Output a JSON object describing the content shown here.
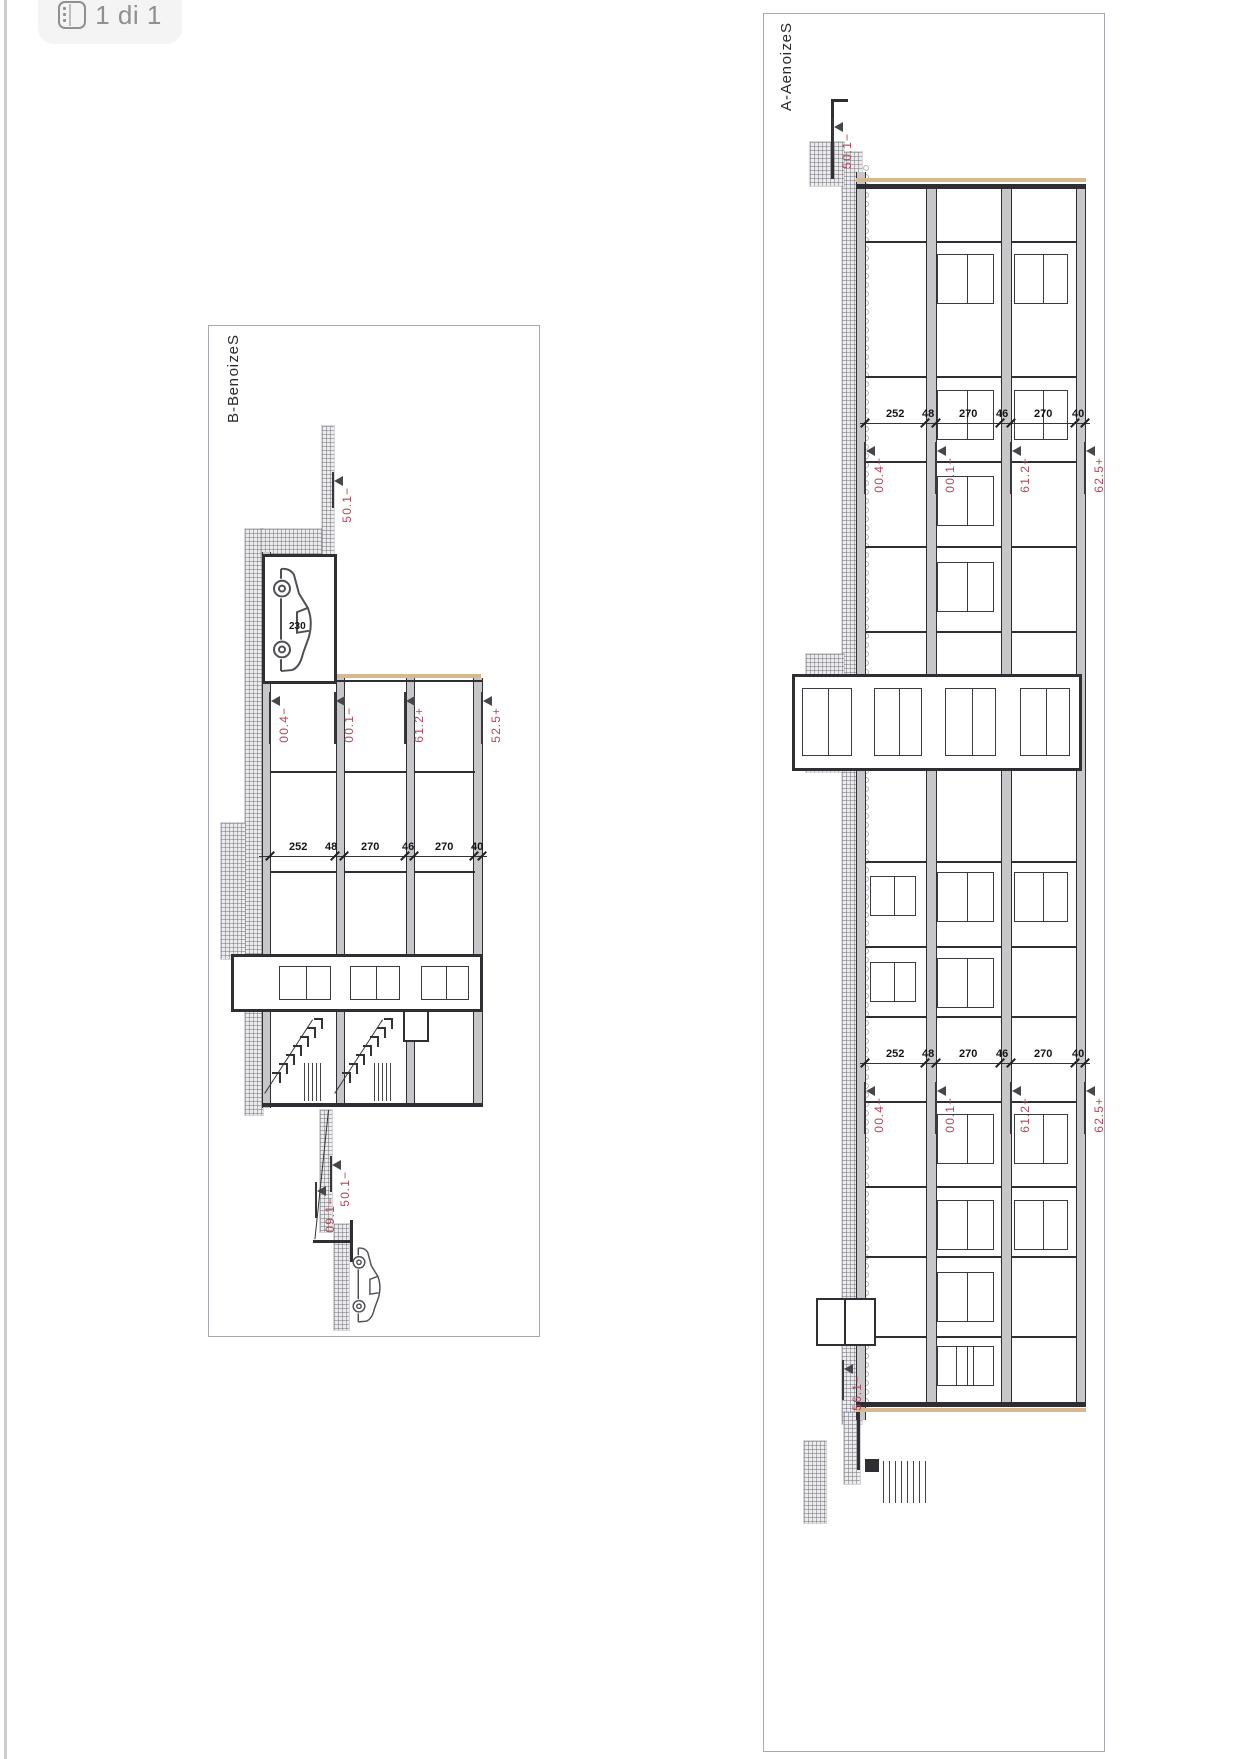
{
  "toolbar": {
    "page_indicator": "1 di 1",
    "icon": "pages-icon"
  },
  "colors": {
    "red": "#bd4258",
    "line": "#2e2e33",
    "slab_fill": "#c7c7ca",
    "tan": "#d8b88e",
    "panel_border": "#a8a8b0"
  },
  "panels": [
    {
      "id": "bb",
      "title": "Sezione B-B",
      "frame": {
        "left": 208,
        "top": 325,
        "width": 332,
        "height": 1012
      },
      "natural": {
        "w": 1012,
        "h": 332
      },
      "prims": [
        {
          "t": "title",
          "x": 8,
          "y": 300,
          "text": "Sezione B-B",
          "size": 15
        },
        {
          "t": "hatch",
          "x": 203,
          "y": 278,
          "w": 586,
          "h": 18
        },
        {
          "t": "hatch",
          "x": 203,
          "y": 214,
          "w": 32,
          "h": 66
        },
        {
          "t": "hatch",
          "x": 100,
          "y": 207,
          "w": 136,
          "h": 12
        },
        {
          "t": "hatch",
          "x": 497,
          "y": 296,
          "w": 136,
          "h": 24
        },
        {
          "t": "hatch",
          "x": 784,
          "y": 209,
          "w": 122,
          "h": 12
        },
        {
          "t": "hatch",
          "x": 898,
          "y": 192,
          "w": 106,
          "h": 15
        },
        {
          "t": "slab",
          "x": 352,
          "y": 58,
          "w": 428,
          "h": 10
        },
        {
          "t": "slab",
          "x": 352,
          "y": 126,
          "w": 428,
          "h": 9
        },
        {
          "t": "slab",
          "x": 352,
          "y": 196,
          "w": 428,
          "h": 9
        },
        {
          "t": "slab",
          "x": 228,
          "y": 204,
          "w": 130,
          "h": 8
        },
        {
          "t": "slab",
          "x": 226,
          "y": 270,
          "w": 556,
          "h": 9
        },
        {
          "t": "vline",
          "x": 777,
          "y": 58,
          "len": 221,
          "w": 4
        },
        {
          "t": "tan",
          "x": 348,
          "y": 60,
          "len": 144,
          "w": 4
        },
        {
          "t": "vline",
          "x": 354,
          "y": 58,
          "len": 146,
          "w": 2
        },
        {
          "t": "rect",
          "x": 228,
          "y": 204,
          "w": 130,
          "h": 75,
          "bw": 3
        },
        {
          "t": "vline",
          "x": 445,
          "y": 66,
          "len": 60,
          "w": 2
        },
        {
          "t": "vline",
          "x": 445,
          "y": 135,
          "len": 61,
          "w": 2
        },
        {
          "t": "vline",
          "x": 445,
          "y": 205,
          "len": 65,
          "w": 2
        },
        {
          "t": "vline",
          "x": 545,
          "y": 66,
          "len": 60,
          "w": 2
        },
        {
          "t": "vline",
          "x": 545,
          "y": 135,
          "len": 61,
          "w": 2
        },
        {
          "t": "vline",
          "x": 545,
          "y": 205,
          "len": 65,
          "w": 2
        },
        {
          "t": "rect",
          "x": 628,
          "y": 58,
          "w": 58,
          "h": 252,
          "bw": 3
        },
        {
          "t": "door",
          "x": 640,
          "y": 72,
          "w": 34,
          "h": 48
        },
        {
          "t": "door",
          "x": 640,
          "y": 141,
          "w": 34,
          "h": 50
        },
        {
          "t": "door",
          "x": 640,
          "y": 210,
          "w": 34,
          "h": 52
        },
        {
          "t": "rect",
          "x": 684,
          "y": 112,
          "w": 32,
          "h": 26,
          "bw": 2
        },
        {
          "t": "steps",
          "x": 692,
          "y": 148,
          "n": 7,
          "dx": 9,
          "dy": 7
        },
        {
          "t": "diag",
          "x": 694,
          "y": 158,
          "len": 88,
          "a": 33
        },
        {
          "t": "steps",
          "x": 692,
          "y": 218,
          "n": 7,
          "dx": 9,
          "dy": 7
        },
        {
          "t": "diag",
          "x": 694,
          "y": 228,
          "len": 88,
          "a": 33
        },
        {
          "t": "pack",
          "x": 737,
          "y": 150,
          "n": 5,
          "gap": 4,
          "len": 38
        },
        {
          "t": "pack",
          "x": 737,
          "y": 220,
          "n": 5,
          "gap": 4,
          "len": 38
        },
        {
          "t": "car",
          "x": 240,
          "y": 226,
          "w": 108,
          "h": 44
        },
        {
          "t": "num",
          "x": 296,
          "y": 252,
          "text": "230",
          "size": 10
        },
        {
          "t": "chain",
          "x": 530,
          "y": 54,
          "len": 228
        },
        {
          "t": "ticks",
          "x": 530,
          "ys": [
            58,
            66,
            126,
            135,
            196,
            205,
            270
          ]
        },
        {
          "t": "num",
          "x": 516,
          "y": 252,
          "text": "252",
          "size": 11
        },
        {
          "t": "num",
          "x": 516,
          "y": 216,
          "text": "48",
          "size": 11
        },
        {
          "t": "num",
          "x": 516,
          "y": 180,
          "text": "270",
          "size": 11
        },
        {
          "t": "num",
          "x": 516,
          "y": 139,
          "text": "46",
          "size": 11
        },
        {
          "t": "num",
          "x": 516,
          "y": 106,
          "text": "270",
          "size": 11
        },
        {
          "t": "num",
          "x": 516,
          "y": 70,
          "text": "40",
          "size": 11
        },
        {
          "t": "marker",
          "x": 366,
          "y": 270,
          "text": "−4.00"
        },
        {
          "t": "marker",
          "x": 366,
          "y": 205,
          "text": "−1.00"
        },
        {
          "t": "marker",
          "x": 366,
          "y": 135,
          "text": "+2.16"
        },
        {
          "t": "marker",
          "x": 366,
          "y": 58,
          "text": "+5.25"
        },
        {
          "t": "marker",
          "x": 146,
          "y": 207,
          "text": "−1.05",
          "len": 36
        },
        {
          "t": "marker",
          "x": 830,
          "y": 209,
          "text": "−1.05",
          "len": 36
        },
        {
          "t": "marker",
          "x": 856,
          "y": 224,
          "text": "−1.90",
          "len": 36
        },
        {
          "t": "diag",
          "x": 784,
          "y": 212,
          "len": 130,
          "a": 6
        },
        {
          "t": "vline",
          "x": 914,
          "y": 190,
          "len": 38,
          "w": 3
        },
        {
          "t": "hline",
          "x": 894,
          "y": 188,
          "len": 42,
          "w": 3
        },
        {
          "t": "car",
          "x": 920,
          "y": 158,
          "w": 78,
          "h": 32
        }
      ]
    },
    {
      "id": "aa",
      "title": "Sezione A-A",
      "frame": {
        "left": 763,
        "top": 13,
        "width": 342,
        "height": 1739
      },
      "natural": {
        "w": 1739,
        "h": 342
      },
      "prims": [
        {
          "t": "title",
          "x": 8,
          "y": 312,
          "text": "Sezione A-A",
          "size": 15
        },
        {
          "t": "hatch",
          "x": 138,
          "y": 244,
          "w": 1272,
          "h": 20
        },
        {
          "t": "pebbles",
          "x": 150,
          "y": 236,
          "w": 1240,
          "h": 8
        },
        {
          "t": "hatch",
          "x": 640,
          "y": 262,
          "w": 118,
          "h": 38
        },
        {
          "t": "hatch",
          "x": 128,
          "y": 262,
          "w": 44,
          "h": 34
        },
        {
          "t": "hatch",
          "x": 1398,
          "y": 246,
          "w": 72,
          "h": 16
        },
        {
          "t": "hatch",
          "x": 1427,
          "y": 280,
          "w": 82,
          "h": 22
        },
        {
          "t": "slab",
          "x": 170,
          "y": 20,
          "w": 1222,
          "h": 10
        },
        {
          "t": "slab",
          "x": 170,
          "y": 94,
          "w": 1222,
          "h": 11
        },
        {
          "t": "slab",
          "x": 170,
          "y": 169,
          "w": 1222,
          "h": 11
        },
        {
          "t": "slab",
          "x": 158,
          "y": 240,
          "w": 1248,
          "h": 10
        },
        {
          "t": "vline",
          "x": 170,
          "y": 20,
          "len": 230,
          "w": 5
        },
        {
          "t": "vline",
          "x": 1388,
          "y": 20,
          "len": 230,
          "w": 5
        },
        {
          "t": "tan",
          "x": 164,
          "y": 20,
          "len": 230,
          "w": 4
        },
        {
          "t": "tan",
          "x": 1394,
          "y": 20,
          "len": 230,
          "w": 4
        },
        {
          "t": "wallset",
          "xs": [
            227,
            362,
            447,
            532,
            617,
            847,
            932,
            1002,
            1087,
            1172,
            1242,
            1322
          ],
          "w": 2
        },
        {
          "t": "rect",
          "x": 660,
          "y": 24,
          "w": 97,
          "h": 290,
          "bw": 3
        },
        {
          "t": "door",
          "x": 674,
          "y": 36,
          "w": 68,
          "h": 50
        },
        {
          "t": "door",
          "x": 674,
          "y": 110,
          "w": 68,
          "h": 51
        },
        {
          "t": "door",
          "x": 674,
          "y": 184,
          "w": 68,
          "h": 48
        },
        {
          "t": "door",
          "x": 674,
          "y": 254,
          "w": 68,
          "h": 50
        },
        {
          "t": "door",
          "x": 240,
          "y": 112,
          "w": 50,
          "h": 57
        },
        {
          "t": "door",
          "x": 376,
          "y": 112,
          "w": 50,
          "h": 57
        },
        {
          "t": "door",
          "x": 462,
          "y": 112,
          "w": 50,
          "h": 57
        },
        {
          "t": "door",
          "x": 548,
          "y": 112,
          "w": 50,
          "h": 57
        },
        {
          "t": "door",
          "x": 858,
          "y": 112,
          "w": 50,
          "h": 57
        },
        {
          "t": "door",
          "x": 944,
          "y": 112,
          "w": 50,
          "h": 57
        },
        {
          "t": "door",
          "x": 1100,
          "y": 112,
          "w": 50,
          "h": 57
        },
        {
          "t": "door",
          "x": 1186,
          "y": 112,
          "w": 50,
          "h": 57
        },
        {
          "t": "door",
          "x": 1258,
          "y": 112,
          "w": 50,
          "h": 57
        },
        {
          "t": "door",
          "x": 1332,
          "y": 112,
          "w": 40,
          "h": 57
        },
        {
          "t": "door",
          "x": 240,
          "y": 38,
          "w": 50,
          "h": 54
        },
        {
          "t": "door",
          "x": 376,
          "y": 38,
          "w": 50,
          "h": 54
        },
        {
          "t": "door",
          "x": 858,
          "y": 38,
          "w": 50,
          "h": 54
        },
        {
          "t": "door",
          "x": 1100,
          "y": 38,
          "w": 50,
          "h": 54
        },
        {
          "t": "door",
          "x": 1186,
          "y": 38,
          "w": 50,
          "h": 54
        },
        {
          "t": "door",
          "x": 862,
          "y": 190,
          "w": 40,
          "h": 46
        },
        {
          "t": "door",
          "x": 948,
          "y": 190,
          "w": 40,
          "h": 46
        },
        {
          "t": "door",
          "x": 1332,
          "y": 132,
          "w": 40,
          "h": 38
        },
        {
          "t": "chain",
          "x": 409,
          "y": 16,
          "len": 230
        },
        {
          "t": "chain",
          "x": 1049,
          "y": 16,
          "len": 230
        },
        {
          "t": "ticks",
          "x": 409,
          "ys": [
            20,
            30,
            94,
            105,
            169,
            180,
            240
          ]
        },
        {
          "t": "ticks",
          "x": 1049,
          "ys": [
            20,
            30,
            94,
            105,
            169,
            180,
            240
          ]
        },
        {
          "t": "num",
          "x": 395,
          "y": 220,
          "text": "252",
          "size": 11
        },
        {
          "t": "num",
          "x": 395,
          "y": 184,
          "text": "48",
          "size": 11
        },
        {
          "t": "num",
          "x": 395,
          "y": 147,
          "text": "270",
          "size": 11
        },
        {
          "t": "num",
          "x": 395,
          "y": 110,
          "text": "46",
          "size": 11
        },
        {
          "t": "num",
          "x": 395,
          "y": 72,
          "text": "270",
          "size": 11
        },
        {
          "t": "num",
          "x": 395,
          "y": 34,
          "text": "40",
          "size": 11
        },
        {
          "t": "num",
          "x": 1035,
          "y": 220,
          "text": "252",
          "size": 11
        },
        {
          "t": "num",
          "x": 1035,
          "y": 184,
          "text": "48",
          "size": 11
        },
        {
          "t": "num",
          "x": 1035,
          "y": 147,
          "text": "270",
          "size": 11
        },
        {
          "t": "num",
          "x": 1035,
          "y": 110,
          "text": "46",
          "size": 11
        },
        {
          "t": "num",
          "x": 1035,
          "y": 72,
          "text": "270",
          "size": 11
        },
        {
          "t": "num",
          "x": 1035,
          "y": 34,
          "text": "40",
          "size": 11
        },
        {
          "t": "marker",
          "x": 428,
          "y": 240,
          "text": "−4.00"
        },
        {
          "t": "marker",
          "x": 428,
          "y": 169,
          "text": "−1.00"
        },
        {
          "t": "marker",
          "x": 428,
          "y": 94,
          "text": "+2.16"
        },
        {
          "t": "marker",
          "x": 428,
          "y": 20,
          "text": "+5.26"
        },
        {
          "t": "marker",
          "x": 1068,
          "y": 240,
          "text": "−4.00"
        },
        {
          "t": "marker",
          "x": 1068,
          "y": 169,
          "text": "−1.00"
        },
        {
          "t": "marker",
          "x": 1068,
          "y": 94,
          "text": "+2.16"
        },
        {
          "t": "marker",
          "x": 1068,
          "y": 20,
          "text": "+5.26"
        },
        {
          "t": "hline",
          "x": 85,
          "y": 272,
          "len": 80,
          "w": 3
        },
        {
          "t": "vline",
          "x": 85,
          "y": 258,
          "len": 16,
          "w": 3
        },
        {
          "t": "marker",
          "x": 104,
          "y": 272,
          "text": "−1.05",
          "len": 40
        },
        {
          "t": "pack",
          "x": 1447,
          "y": 180,
          "n": 8,
          "gap": 6,
          "len": 42
        },
        {
          "t": "hline",
          "x": 1398,
          "y": 246,
          "len": 58,
          "w": 3
        },
        {
          "t": "rect",
          "x": 1445,
          "y": 227,
          "w": 13,
          "h": 14,
          "bw": 0,
          "bg": "#2e2e33"
        },
        {
          "t": "rect",
          "x": 1284,
          "y": 230,
          "w": 48,
          "h": 60,
          "bw": 2
        },
        {
          "t": "hline",
          "x": 1284,
          "y": 260,
          "len": 48,
          "w": 1.5
        },
        {
          "t": "marker",
          "x": 1346,
          "y": 262,
          "text": "−1.65",
          "len": 40
        }
      ]
    }
  ]
}
